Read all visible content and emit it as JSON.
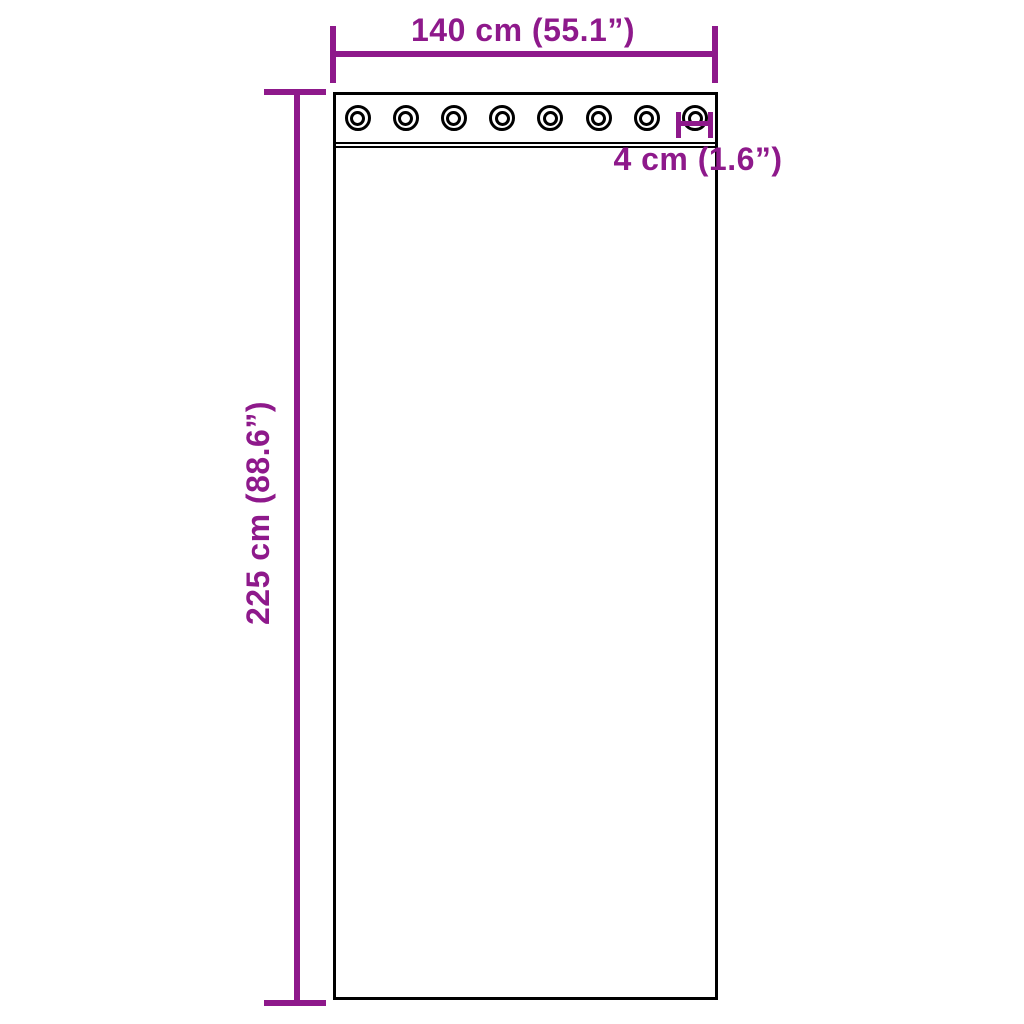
{
  "diagram": {
    "background_color": "#ffffff",
    "outline_color": "#000000",
    "accent_color": "#8e198b",
    "grommet_count": 8,
    "dimensions": {
      "width": {
        "label": "140 cm (55.1”)"
      },
      "height": {
        "label": "225 cm (88.6”)"
      },
      "grommet": {
        "label": "4 cm (1.6”)"
      }
    }
  }
}
